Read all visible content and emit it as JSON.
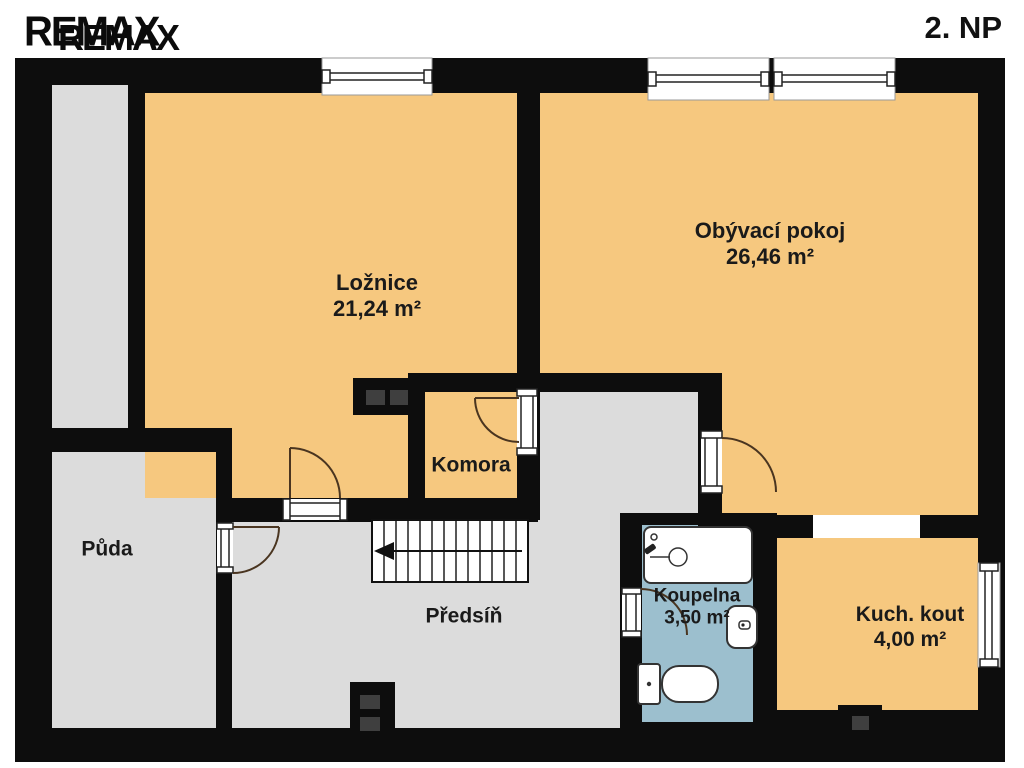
{
  "header": {
    "logo": "REMAX",
    "floor_label": "2. NP"
  },
  "colors": {
    "wall": "#0d0d0d",
    "room_orange": "#f6c87f",
    "room_gray": "#dcdcdc",
    "room_blue": "#9cbfce",
    "background": "#ffffff"
  },
  "rooms": [
    {
      "name": "Ložnice",
      "area": "21,24 m²"
    },
    {
      "name": "Obývací pokoj",
      "area": "26,46 m²"
    },
    {
      "name": "Komora",
      "area": ""
    },
    {
      "name": "Půda",
      "area": ""
    },
    {
      "name": "Předsíň",
      "area": ""
    },
    {
      "name": "Koupelna",
      "area": "3,50 m²"
    },
    {
      "name": "Kuch. kout",
      "area": "4,00 m²"
    }
  ],
  "fixtures": [
    "staircase-down-arrow",
    "bathtub",
    "toilet",
    "sink",
    "chimney-flues",
    "windows",
    "door-swings"
  ]
}
